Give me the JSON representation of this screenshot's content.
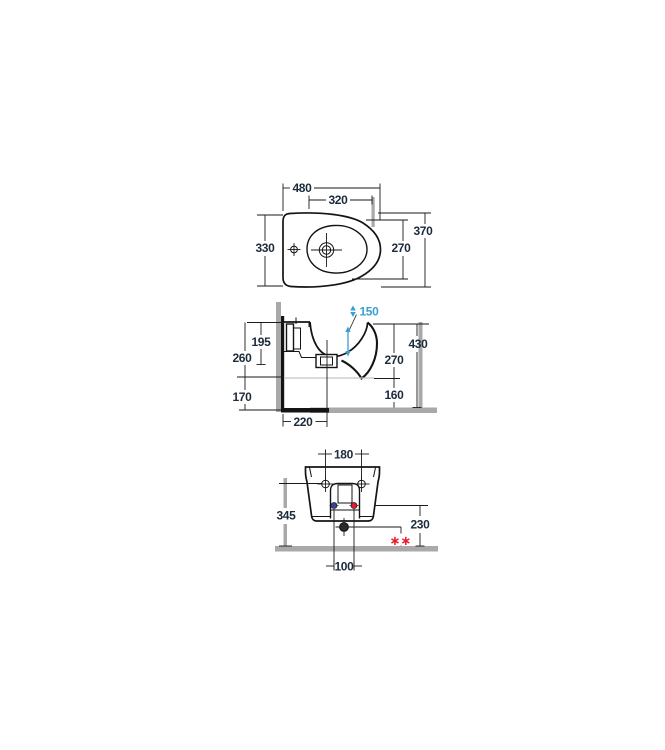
{
  "drawing": {
    "product": "Wall-hung bidet installation drawing",
    "views": {
      "top": {
        "overall_width": "480",
        "inner_width": "320",
        "side_depth": "330",
        "overall_depth": "370",
        "inner_depth": "270"
      },
      "side": {
        "bracket_height": "195",
        "back_height": "260",
        "back_clearance": "170",
        "bowl_water_depth": "150",
        "rim_height": "430",
        "front_body_height": "270",
        "underside_clearance": "160",
        "wall_to_drain": "220"
      },
      "front": {
        "fixing_hole_spacing": "180",
        "fixing_hole_height": "345",
        "inlet_height": "230",
        "inlet_spacing": "100",
        "note_marker": "∗∗"
      }
    },
    "colors": {
      "line": "#1a1a1a",
      "dim_text": "#1c2a3a",
      "accent_blue": "#3a9fd5",
      "accent_red": "#e8192c",
      "cold_inlet_blue": "#3c3f9e",
      "wall_gray": "#a9a9a9",
      "shadow_line": "#c4c4c4"
    }
  }
}
